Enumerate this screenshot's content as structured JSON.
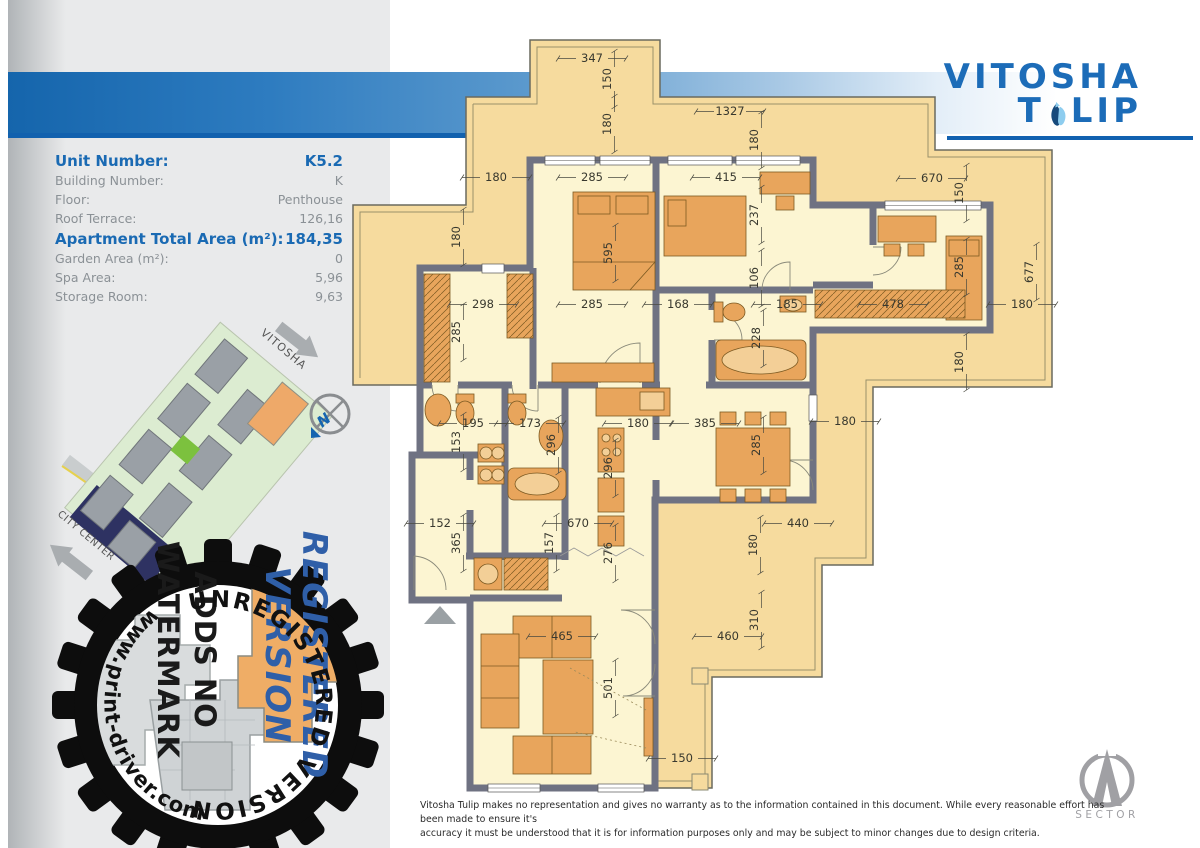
{
  "header": {
    "logo_word1": "VITOSHA",
    "logo_word2_pre": "T",
    "logo_word2_post": "LIP",
    "accent_blue": "#1c6cb8",
    "underline_color": "#1161b0"
  },
  "info_panel": {
    "rows": [
      {
        "label": "Unit Number:",
        "value": "K5.2",
        "emphasis": true
      },
      {
        "label": "Building Number:",
        "value": "K",
        "emphasis": false
      },
      {
        "label": "Floor:",
        "value": "Penthouse",
        "emphasis": false
      },
      {
        "label": "Roof Terrace:",
        "value": "126,16",
        "emphasis": false
      },
      {
        "label": "Apartment Total Area (m²):",
        "value": "184,35",
        "emphasis": true
      },
      {
        "label": "Garden Area (m²):",
        "value": "0",
        "emphasis": false
      },
      {
        "label": "Spa Area:",
        "value": "5,96",
        "emphasis": false
      },
      {
        "label": "Storage Room:",
        "value": "9,63",
        "emphasis": false
      }
    ]
  },
  "site_map": {
    "direction_vitosha": "VITOSHA",
    "direction_city_center": "CITY CENTER",
    "compass_letter": "N"
  },
  "watermark": {
    "arc_top": "UNREGISTERED VERSION",
    "arc_side": "www.print-driver.com",
    "stamp_lines": [
      "REGISTERED",
      "VERSION",
      "ADDS NO",
      "WATERMARK"
    ]
  },
  "floor_plan": {
    "wall_color": "#6f7282",
    "terrace_color": "#f6db9e",
    "interior_color": "#fcf5d2",
    "furniture_color": "#e8a55c",
    "dimensions": [
      {
        "v": "347",
        "x": 592,
        "y": 62,
        "o": "h"
      },
      {
        "v": "150",
        "x": 611,
        "y": 79,
        "o": "v"
      },
      {
        "v": "1327",
        "x": 730,
        "y": 115,
        "o": "h"
      },
      {
        "v": "180",
        "x": 611,
        "y": 124,
        "o": "v"
      },
      {
        "v": "180",
        "x": 758,
        "y": 140,
        "o": "v"
      },
      {
        "v": "180",
        "x": 496,
        "y": 181,
        "o": "h"
      },
      {
        "v": "285",
        "x": 592,
        "y": 181,
        "o": "h"
      },
      {
        "v": "415",
        "x": 726,
        "y": 181,
        "o": "h"
      },
      {
        "v": "670",
        "x": 932,
        "y": 182,
        "o": "h"
      },
      {
        "v": "150",
        "x": 963,
        "y": 193,
        "o": "v"
      },
      {
        "v": "237",
        "x": 758,
        "y": 215,
        "o": "v"
      },
      {
        "v": "180",
        "x": 460,
        "y": 237,
        "o": "v"
      },
      {
        "v": "595",
        "x": 612,
        "y": 253,
        "o": "v"
      },
      {
        "v": "285",
        "x": 963,
        "y": 267,
        "o": "v"
      },
      {
        "v": "677",
        "x": 1033,
        "y": 272,
        "o": "v"
      },
      {
        "v": "106",
        "x": 758,
        "y": 278,
        "o": "v"
      },
      {
        "v": "298",
        "x": 483,
        "y": 308,
        "o": "h"
      },
      {
        "v": "285",
        "x": 592,
        "y": 308,
        "o": "h"
      },
      {
        "v": "168",
        "x": 678,
        "y": 308,
        "o": "h"
      },
      {
        "v": "185",
        "x": 787,
        "y": 308,
        "o": "h"
      },
      {
        "v": "478",
        "x": 893,
        "y": 308,
        "o": "h"
      },
      {
        "v": "180",
        "x": 1022,
        "y": 308,
        "o": "h"
      },
      {
        "v": "285",
        "x": 460,
        "y": 332,
        "o": "v"
      },
      {
        "v": "228",
        "x": 760,
        "y": 338,
        "o": "v"
      },
      {
        "v": "180",
        "x": 963,
        "y": 362,
        "o": "v"
      },
      {
        "v": "195",
        "x": 473,
        "y": 427,
        "o": "h"
      },
      {
        "v": "173",
        "x": 530,
        "y": 427,
        "o": "h"
      },
      {
        "v": "180",
        "x": 638,
        "y": 427,
        "o": "h"
      },
      {
        "v": "385",
        "x": 705,
        "y": 427,
        "o": "h"
      },
      {
        "v": "180",
        "x": 845,
        "y": 425,
        "o": "h"
      },
      {
        "v": "153",
        "x": 460,
        "y": 442,
        "o": "v"
      },
      {
        "v": "296",
        "x": 555,
        "y": 445,
        "o": "v"
      },
      {
        "v": "285",
        "x": 760,
        "y": 445,
        "o": "v"
      },
      {
        "v": "296",
        "x": 612,
        "y": 468,
        "o": "v"
      },
      {
        "v": "152",
        "x": 440,
        "y": 527,
        "o": "h"
      },
      {
        "v": "670",
        "x": 578,
        "y": 527,
        "o": "h"
      },
      {
        "v": "440",
        "x": 798,
        "y": 527,
        "o": "h"
      },
      {
        "v": "365",
        "x": 460,
        "y": 543,
        "o": "v"
      },
      {
        "v": "157",
        "x": 553,
        "y": 543,
        "o": "v"
      },
      {
        "v": "276",
        "x": 612,
        "y": 553,
        "o": "v"
      },
      {
        "v": "180",
        "x": 757,
        "y": 545,
        "o": "v"
      },
      {
        "v": "465",
        "x": 562,
        "y": 640,
        "o": "h"
      },
      {
        "v": "460",
        "x": 728,
        "y": 640,
        "o": "h"
      },
      {
        "v": "310",
        "x": 758,
        "y": 620,
        "o": "v"
      },
      {
        "v": "501",
        "x": 612,
        "y": 688,
        "o": "v"
      },
      {
        "v": "150",
        "x": 682,
        "y": 762,
        "o": "h"
      }
    ]
  },
  "footer": {
    "disclaimer_line1": "Vitosha Tulip makes no representation and gives no warranty as to the information contained in this document. While every reasonable effort has been made to ensure it's",
    "disclaimer_line2": "accuracy it must be understood that it is for information purposes only and may be subject to minor changes due to design criteria.",
    "brand": "SECTOR"
  }
}
